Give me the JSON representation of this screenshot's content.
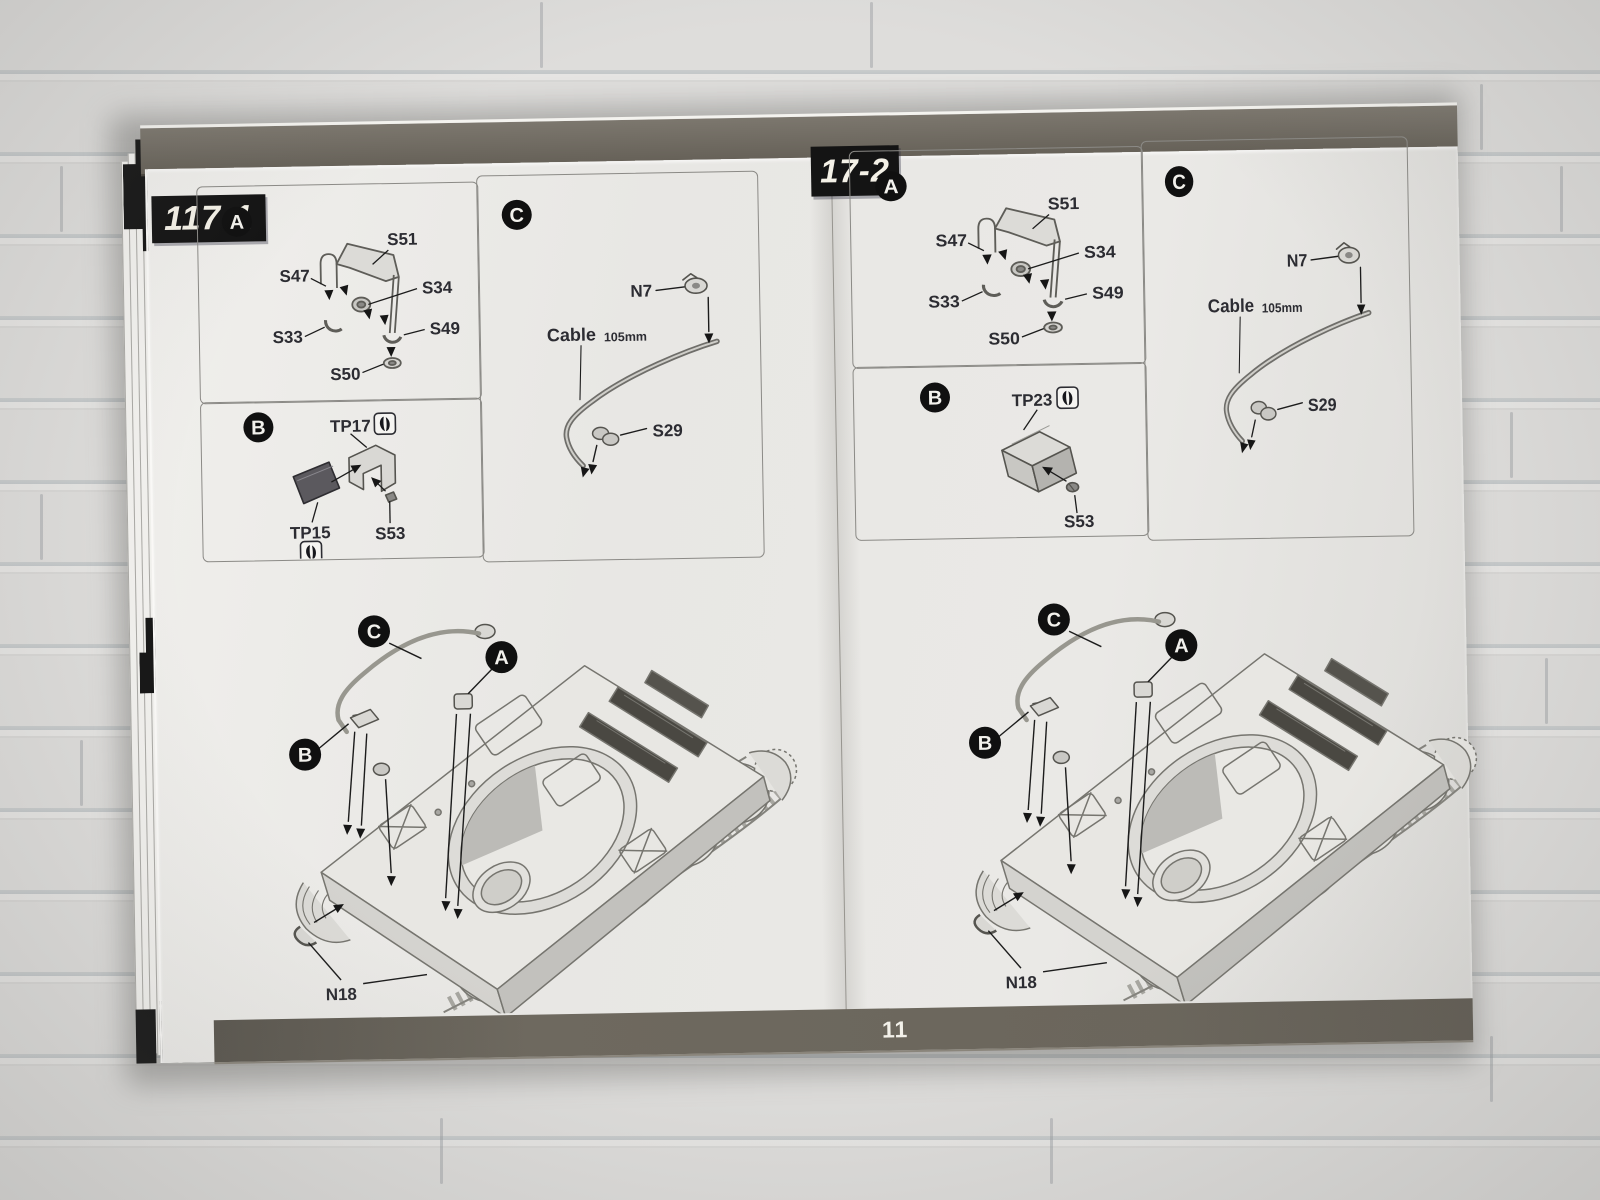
{
  "page_number": "11",
  "edge_digit": "1",
  "colors": {
    "band": "#6b665c",
    "label_bg": "#141414",
    "label_text": "#f4f1e7",
    "paper": "#e9e8e5",
    "line_art": "#74736e"
  },
  "icons": {
    "pe_symbol": "double-comma mark in rounded square",
    "callout": "white letter in black circle"
  },
  "steps": [
    {
      "label": "117-1",
      "panel_a": {
        "letter": "A",
        "s51": "S51",
        "s47": "S47",
        "s34": "S34",
        "s33": "S33",
        "s49": "S49",
        "s50": "S50"
      },
      "panel_b": {
        "letter": "B",
        "top": "TP17",
        "left": "TP15",
        "right": "S53"
      },
      "panel_c": {
        "letter": "C",
        "hook": "N7",
        "cable": "Cable",
        "size": "105mm",
        "clamp": "S29"
      },
      "assembly": {
        "c": "C",
        "a": "A",
        "b": "B",
        "n18": "N18"
      }
    },
    {
      "label": "17-2",
      "panel_a": {
        "letter": "A",
        "s51": "S51",
        "s47": "S47",
        "s34": "S34",
        "s33": "S33",
        "s49": "S49",
        "s50": "S50"
      },
      "panel_b": {
        "letter": "B",
        "top": "TP23",
        "right": "S53"
      },
      "panel_c": {
        "letter": "C",
        "hook": "N7",
        "cable": "Cable",
        "size": "105mm",
        "clamp": "S29"
      },
      "assembly": {
        "c": "C",
        "a": "A",
        "b": "B",
        "n18": "N18"
      }
    }
  ]
}
